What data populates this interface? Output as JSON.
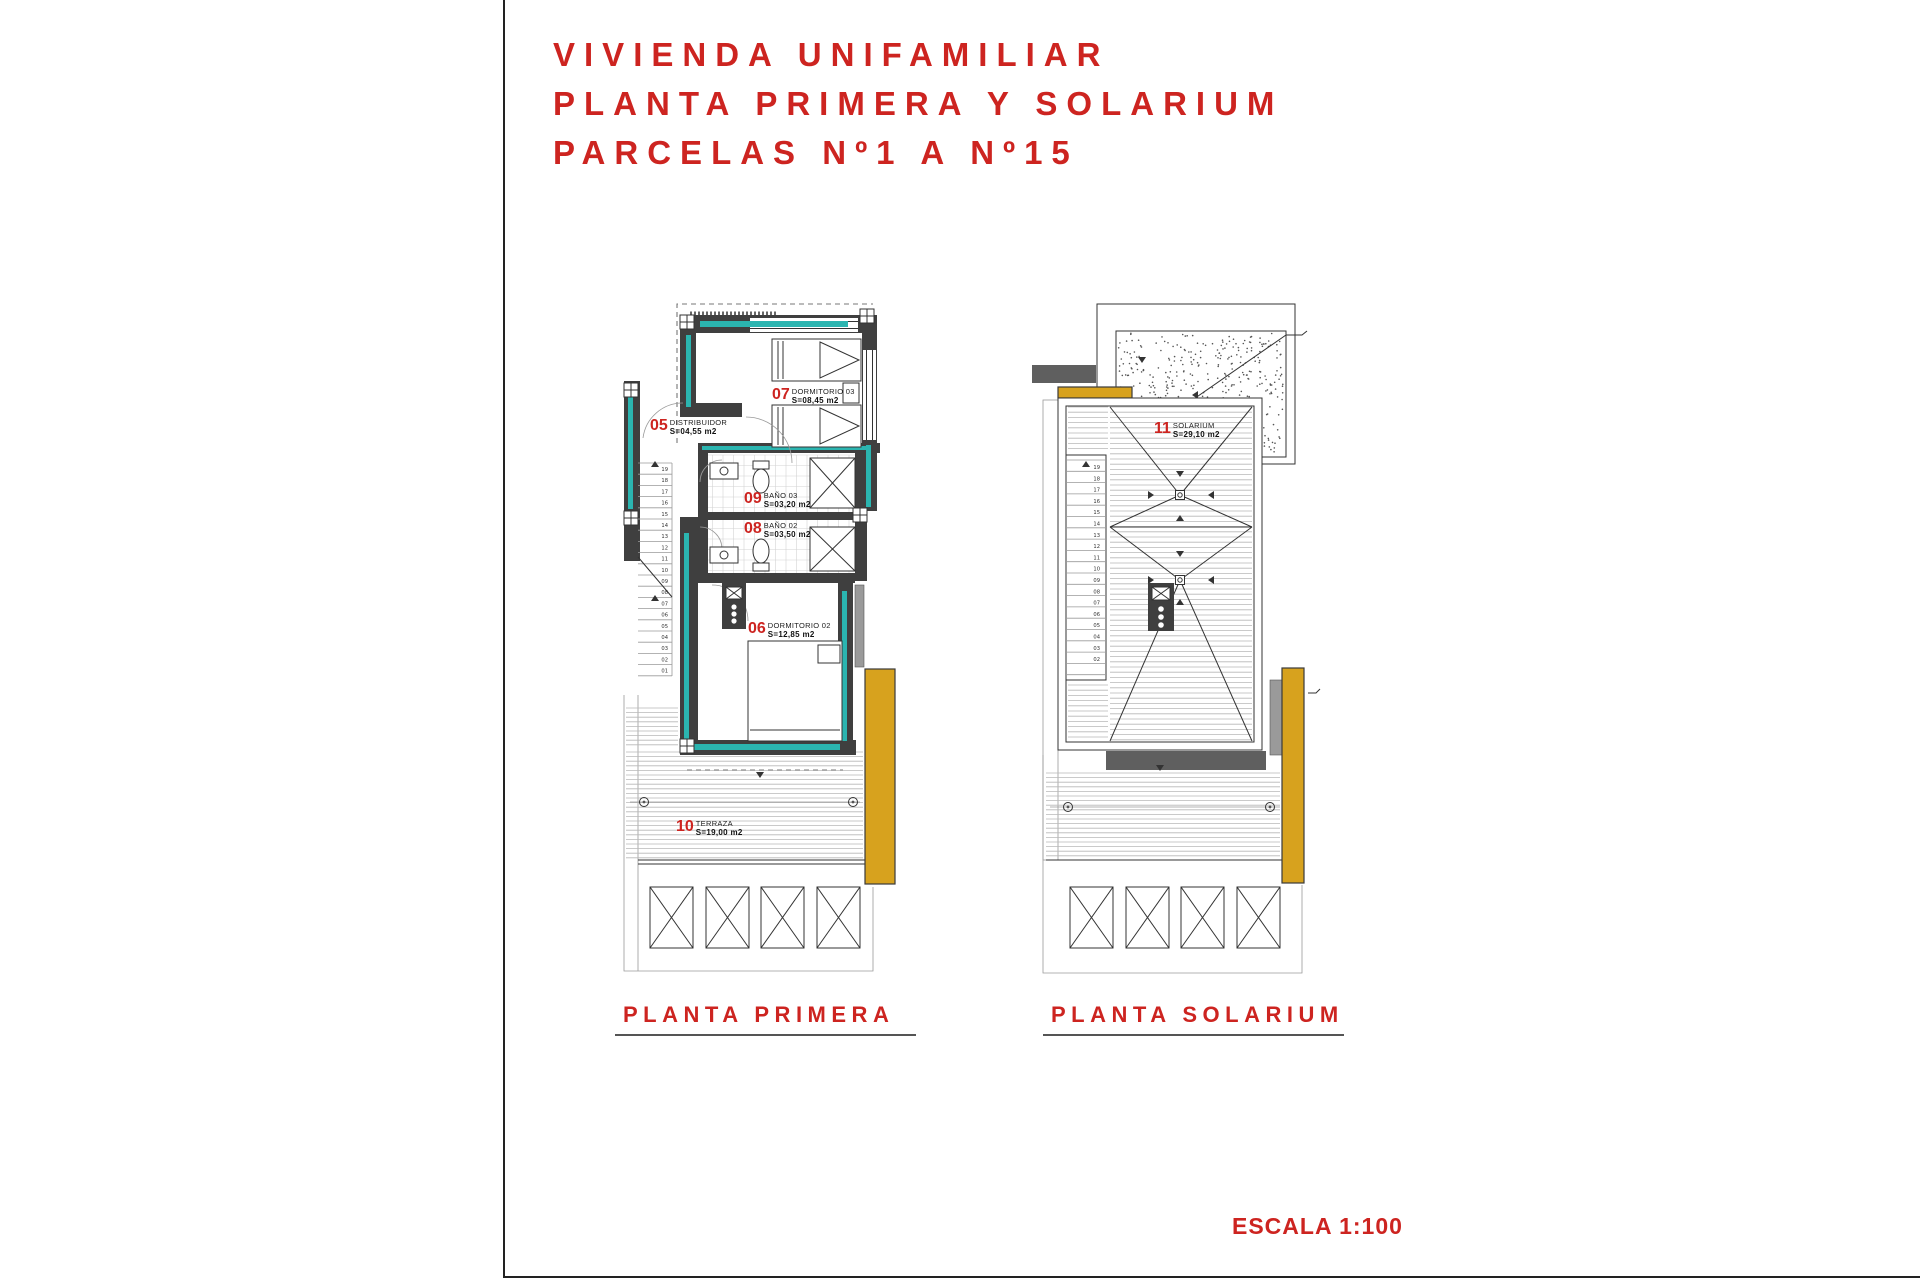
{
  "title": {
    "line1": "VIVIENDA UNIFAMILIAR",
    "line2": "PLANTA PRIMERA Y SOLARIUM",
    "line3": "PARCELAS Nº1 A Nº15"
  },
  "captions": {
    "left": "PLANTA PRIMERA",
    "right": "PLANTA SOLARIUM"
  },
  "escala": "ESCALA 1:100",
  "colors": {
    "accent_red": "#cd2420",
    "wall_dark": "#3f3f3f",
    "insulation_teal": "#2bb5b0",
    "wood_yellow": "#d7a21e"
  },
  "planta_primera": {
    "label": "PLANTA PRIMERA",
    "rooms": [
      {
        "num": "05",
        "name": "DISTRIBUIDOR",
        "area": "S=04,55 m2"
      },
      {
        "num": "07",
        "name": "DORMITORIO 03",
        "area": "S=08,45 m2"
      },
      {
        "num": "09",
        "name": "BAÑO 03",
        "area": "S=03,20 m2"
      },
      {
        "num": "08",
        "name": "BAÑO 02",
        "area": "S=03,50 m2"
      },
      {
        "num": "06",
        "name": "DORMITORIO 02",
        "area": "S=12,85 m2"
      },
      {
        "num": "10",
        "name": "TERRAZA",
        "area": "S=19,00 m2"
      }
    ],
    "stairs": [
      "19",
      "18",
      "17",
      "16",
      "15",
      "14",
      "13",
      "12",
      "11",
      "10",
      "09",
      "08",
      "07",
      "06",
      "05",
      "04",
      "03",
      "02",
      "01"
    ]
  },
  "planta_solarium": {
    "label": "PLANTA SOLARIUM",
    "rooms": [
      {
        "num": "11",
        "name": "SOLARIUM",
        "area": "S=29,10 m2"
      }
    ],
    "stairs": [
      "19",
      "18",
      "17",
      "16",
      "15",
      "14",
      "13",
      "12",
      "11",
      "10",
      "09",
      "08",
      "07",
      "06",
      "05",
      "04",
      "03",
      "02"
    ]
  }
}
